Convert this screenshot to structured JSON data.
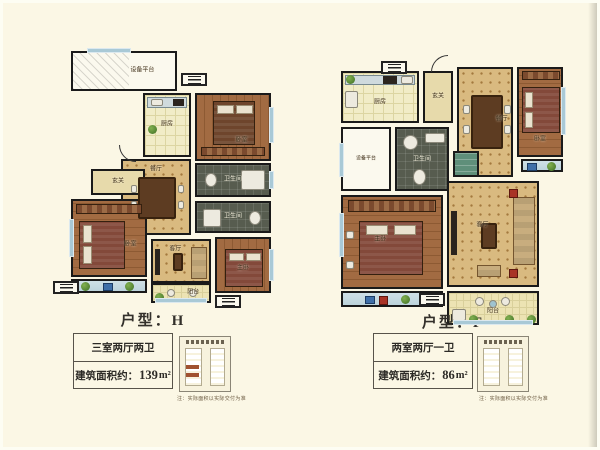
{
  "colors": {
    "background": "#fbf7e5",
    "wall": "#1a1a1a",
    "window_glass": "#a9c9d6",
    "tile_light": "#f1ecc7",
    "tile_dark": "#575c4f",
    "parquet": "#d9ba80",
    "inset_highlight": "#a0512f"
  },
  "plans": [
    {
      "unit_title": "户型：H",
      "spec": "三室两厅两卫",
      "area_label": "建筑面积约：",
      "area_value": "139",
      "area_unit": "m²",
      "note": "注：实际面积以实际交付为准",
      "rooms": {
        "equipment_platform": "设备平台",
        "kitchen": "厨房",
        "bedroom_top": "卧室",
        "dining": "餐厅",
        "bath1": "卫生间",
        "bath2": "卫生间",
        "foyer": "玄关",
        "bedroom_left": "卧室",
        "living": "客厅",
        "master": "主卧",
        "balcony": "阳台"
      }
    },
    {
      "unit_title": "户型：F",
      "spec": "两室两厅一卫",
      "area_label": "建筑面积约：",
      "area_value": "86",
      "area_unit": "m²",
      "note": "注：实际面积以实际交付为准",
      "rooms": {
        "kitchen": "厨房",
        "foyer": "玄关",
        "dining": "餐厅",
        "bedroom": "卧室",
        "equipment_platform": "设备平台",
        "bath": "卫生间",
        "master": "主卧",
        "living": "客厅",
        "balcony": "阳台"
      }
    }
  ]
}
